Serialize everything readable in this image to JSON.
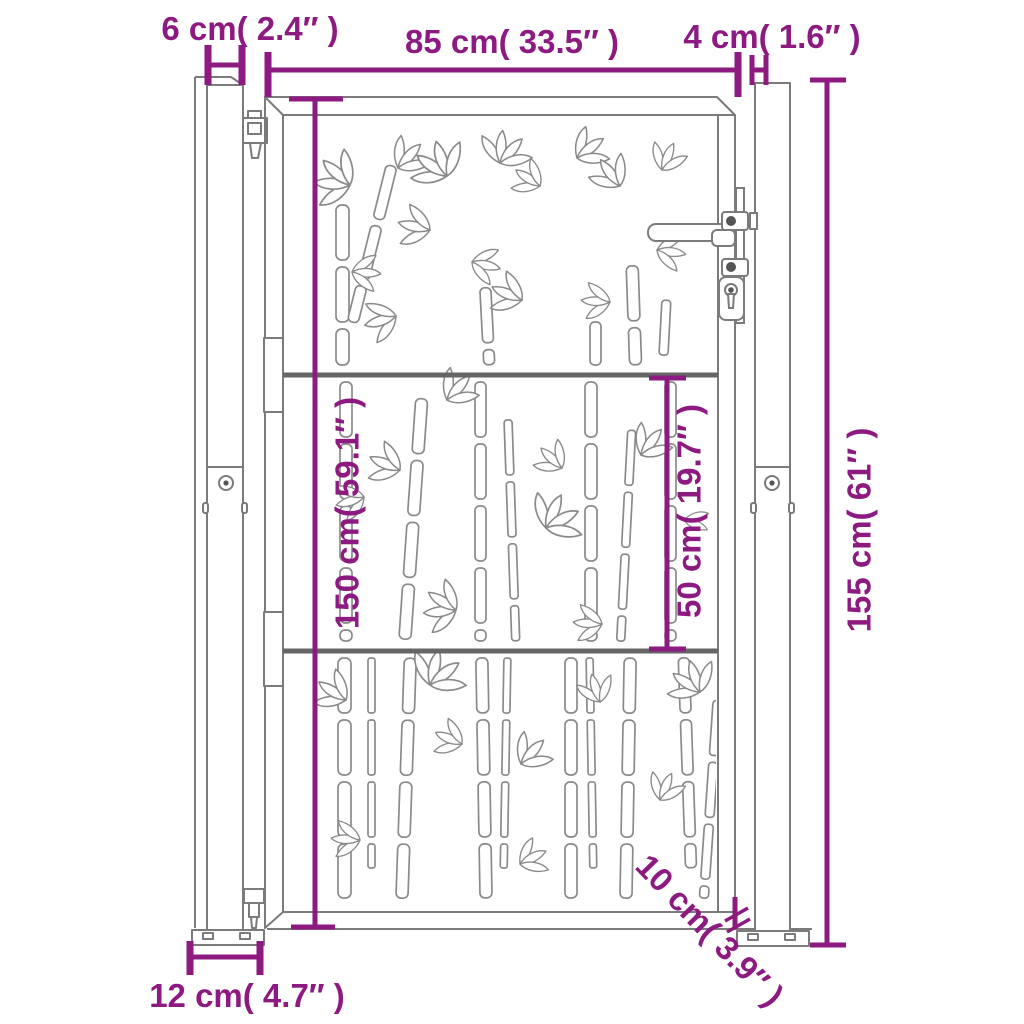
{
  "colors": {
    "dimension": "#8d1a80",
    "outline": "#7b7b7b",
    "rail": "#666666",
    "hardware": "#555555",
    "background": "#ffffff"
  },
  "dimension_labels": {
    "left_post_width": "6 cm( 2.4″ )",
    "gate_width": "85 cm( 33.5″ )",
    "right_post_width": "4 cm( 1.6″ )",
    "total_height": "155 cm( 61″ )",
    "gate_height": "150 cm( 59.1″ )",
    "lower_section_height": "50 cm( 19.7″ )",
    "base_plate_width": "12 cm( 4.7″ )",
    "ground_clearance": "10 cm( 3.9″ )"
  }
}
